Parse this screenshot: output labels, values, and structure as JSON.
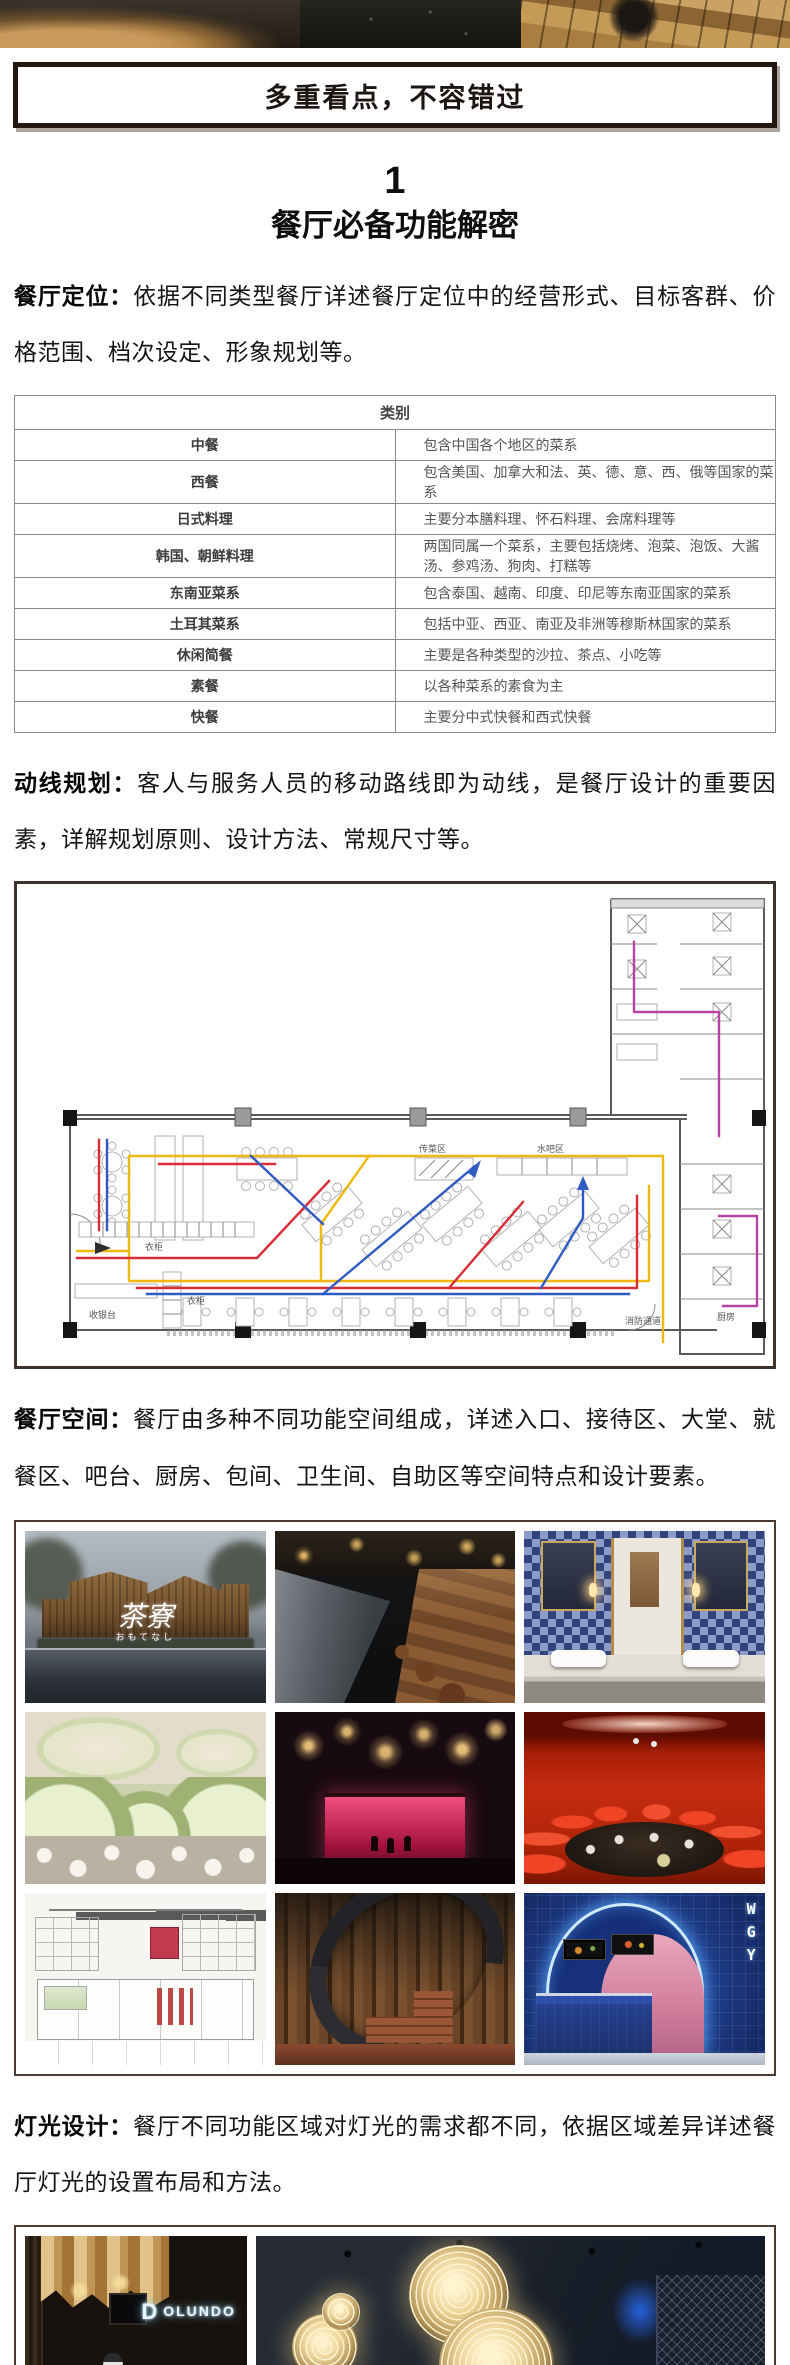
{
  "banner": {
    "title": "多重看点，不容错过"
  },
  "section": {
    "number": "1",
    "title": "餐厅必备功能解密"
  },
  "paragraphs": {
    "positioning": {
      "lead": "餐厅定位：",
      "text": "依据不同类型餐厅详述餐厅定位中的经营形式、目标客群、价格范围、档次设定、形象规划等。"
    },
    "circulation": {
      "lead": "动线规划：",
      "text": "客人与服务人员的移动路线即为动线，是餐厅设计的重要因素，详解规划原则、设计方法、常规尺寸等。"
    },
    "space": {
      "lead": "餐厅空间：",
      "text": "餐厅由多种不同功能空间组成，详述入口、接待区、大堂、就餐区、吧台、厨房、包间、卫生间、自助区等空间特点和设计要素。"
    },
    "lighting": {
      "lead": "灯光设计：",
      "text": "餐厅不同功能区域对灯光的需求都不同，依据区域差异详述餐厅灯光的设置布局和方法。"
    }
  },
  "cuisine_table": {
    "header": "类别",
    "rows": [
      [
        "中餐",
        "包含中国各个地区的菜系"
      ],
      [
        "西餐",
        "包含美国、加拿大和法、英、德、意、西、俄等国家的菜系"
      ],
      [
        "日式料理",
        "主要分本膳料理、怀石料理、会席料理等"
      ],
      [
        "韩国、朝鲜料理",
        "两国同属一个菜系，主要包括烧烤、泡菜、泡饭、大酱汤、参鸡汤、狗肉、打糕等"
      ],
      [
        "东南亚菜系",
        "包含泰国、越南、印度、印尼等东南亚国家的菜系"
      ],
      [
        "土耳其菜系",
        "包括中亚、西亚、南亚及非洲等穆斯林国家的菜系"
      ],
      [
        "休闲简餐",
        "主要是各种类型的沙拉、茶点、小吃等"
      ],
      [
        "素餐",
        "以各种菜系的素食为主"
      ],
      [
        "快餐",
        "主要分中式快餐和西式快餐"
      ]
    ]
  },
  "floorplan": {
    "labels": {
      "cashier": "收银台",
      "wardrobe": "衣柜",
      "wardrobe2": "衣柜",
      "food_pass": "传菜区",
      "water_bar": "水吧区",
      "fire_exit": "消防通道",
      "kitchen": "厨房"
    },
    "route_colors": {
      "guest_yellow": "#f0b400",
      "guest_red": "#d8232e",
      "service_blue": "#2553c0",
      "kitchen_magenta": "#b4399e"
    }
  },
  "photos": {
    "grid": [
      {
        "name": "teahouse-exterior",
        "logo": "茶寮",
        "logo_sub": "おもてなし"
      },
      {
        "name": "open-kitchen-counter"
      },
      {
        "name": "blue-tile-restroom"
      },
      {
        "name": "green-organic-dining-hall"
      },
      {
        "name": "chandelier-stage-bar"
      },
      {
        "name": "red-private-dining-room"
      },
      {
        "name": "sketch-style-cafe"
      },
      {
        "name": "spiral-staircase-interior"
      },
      {
        "name": "blue-arch-food-counter",
        "sign": "WGY"
      }
    ],
    "bottom": [
      {
        "name": "entrance-pendant-lamps",
        "logo_mark": "D",
        "logo_text": "OLUNDO"
      },
      {
        "name": "sphere-chandelier-hall"
      }
    ]
  }
}
